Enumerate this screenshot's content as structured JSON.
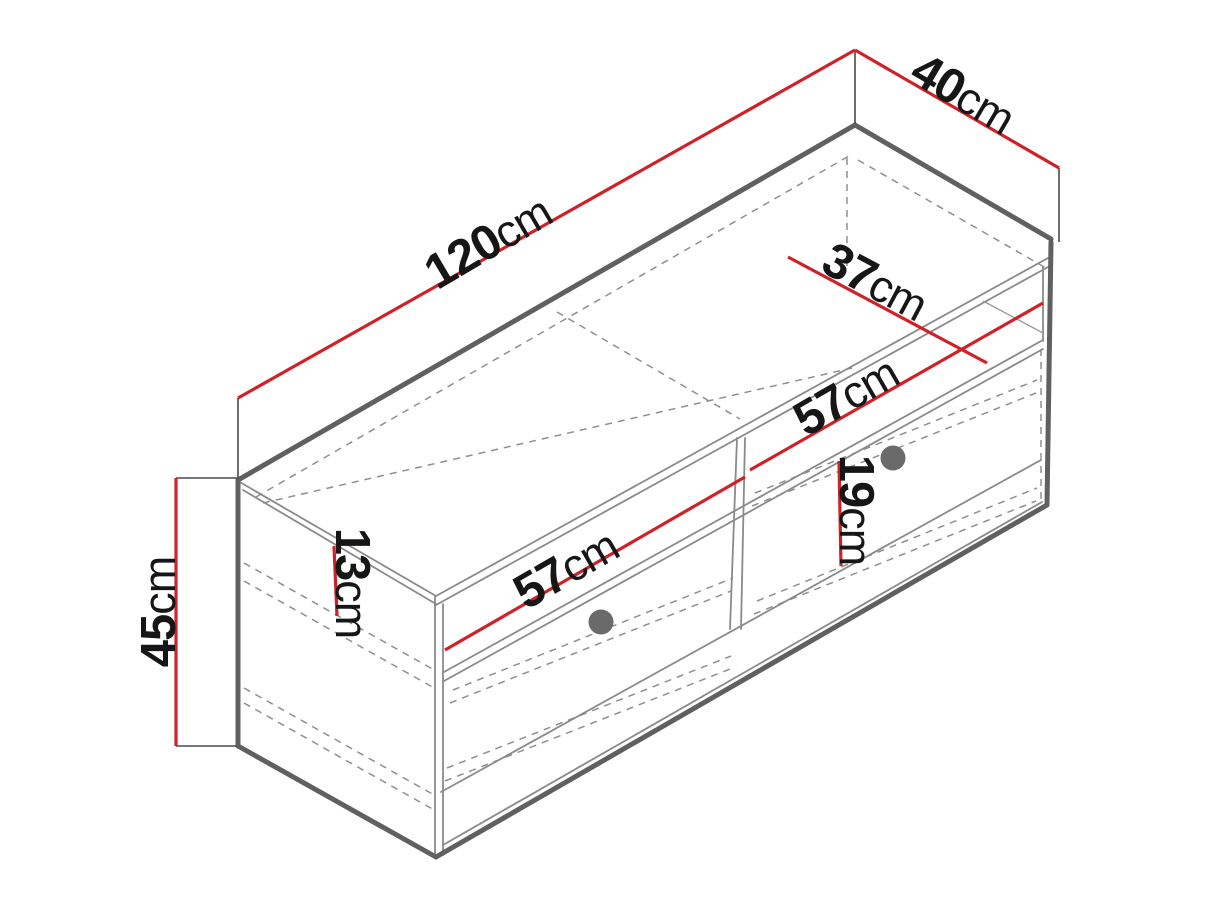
{
  "diagram": {
    "title": "TV cabinet dimension drawing",
    "subject": "isometric line drawing of a TV stand with an open shelf niche (split by a center divider) and two drawers with round knobs",
    "style": "technical line drawing, hidden edges dashed, dimensions in red with black labels",
    "colors": {
      "background": "#ffffff",
      "dimension_line": "#ce2128",
      "edge_dark": "#606060",
      "edge_light": "#8a8a8a",
      "hidden_edge": "#8f8f8f",
      "knob": "#6a6a6a",
      "label_text": "#161616"
    },
    "knobs": {
      "count": 2,
      "shape": "circle"
    },
    "dimensions": [
      {
        "id": "width",
        "value": "120",
        "unit": "cm",
        "meaning": "overall width along top back edge"
      },
      {
        "id": "depth",
        "value": "40",
        "unit": "cm",
        "meaning": "overall depth along top right edge"
      },
      {
        "id": "height",
        "value": "45",
        "unit": "cm",
        "meaning": "overall height at left back edge"
      },
      {
        "id": "inner-depth",
        "value": "37",
        "unit": "cm",
        "meaning": "internal depth across top surface"
      },
      {
        "id": "left-opening",
        "value": "57",
        "unit": "cm",
        "meaning": "left shelf niche width"
      },
      {
        "id": "right-opening",
        "value": "57",
        "unit": "cm",
        "meaning": "right shelf niche width"
      },
      {
        "id": "niche-height",
        "value": "13",
        "unit": "cm",
        "meaning": "shelf niche height (on left side panel)"
      },
      {
        "id": "drawer-height",
        "value": "19",
        "unit": "cm",
        "meaning": "drawer front height"
      }
    ]
  }
}
